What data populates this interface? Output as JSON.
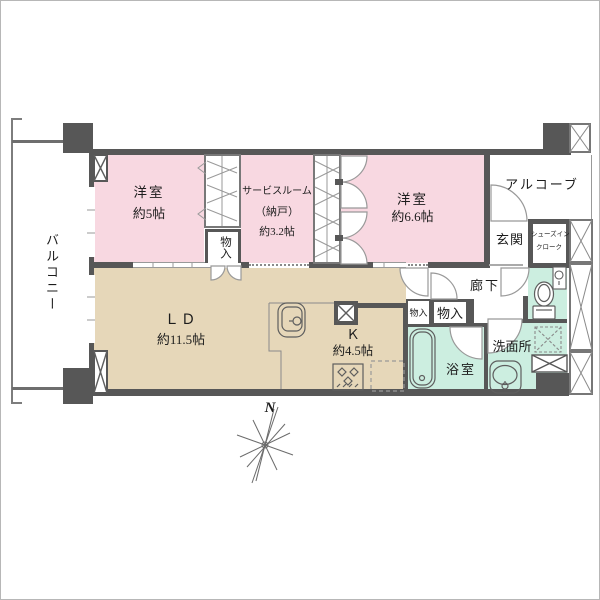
{
  "colors": {
    "room_pink": "#f8d8e1",
    "room_beige": "#e6d7b9",
    "room_wet": "#cceee0",
    "wall": "#575757"
  },
  "labels": {
    "balcony": "バルコニー",
    "bedroom5_name": "洋室",
    "bedroom5_size": "約5帖",
    "service_line1": "サービスルーム",
    "service_line2": "（納戸）",
    "service_line3": "約3.2帖",
    "bedroom66_name": "洋室",
    "bedroom66_size": "約6.6帖",
    "alcove": "アルコーブ",
    "entrance": "玄関",
    "sic_line1": "シューズイン",
    "sic_line2": "クローク",
    "hallway": "廊下",
    "closet_bedroom5": "物入",
    "closet_hall_small": "物入",
    "closet_hall_large": "物入",
    "living_name": "ＬＤ",
    "living_size": "約11.5帖",
    "kitchen_name": "Ｋ",
    "kitchen_size": "約4.5帖",
    "bath": "浴室",
    "washroom": "洗面所",
    "compass_north": "N"
  }
}
